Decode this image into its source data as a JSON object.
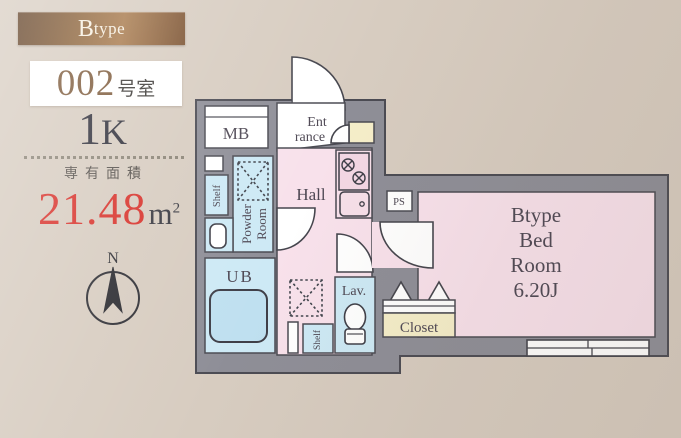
{
  "panel": {
    "type_badge_initial": "B",
    "type_badge_rest": "type",
    "room_no": "002",
    "room_no_suffix": "号室",
    "layout_first": "1",
    "layout_rest": "K",
    "area_caption": "専有面積",
    "area_value": "21.48",
    "area_unit_base": "m",
    "area_unit_exp": "2"
  },
  "compass": {
    "north": "N"
  },
  "floorplan": {
    "labels": {
      "mb": "MB",
      "entrance_l1": "Ent",
      "entrance_l2": "rance",
      "hall": "Hall",
      "ps": "PS",
      "shelf_upper": "Shelf",
      "powder_l1": "Powder",
      "powder_l2": "Room",
      "ub": "UB",
      "shelf_lower": "Shelf",
      "lav": "Lav.",
      "closet": "Closet",
      "bedroom_l1": "Btype",
      "bedroom_l2": "Bed",
      "bedroom_l3": "Room",
      "bedroom_l4": "6.20J"
    },
    "colors": {
      "wall": "#8e8e97",
      "wall_outline": "#4b4b53",
      "pink_room": "#f8e1eb",
      "blue_room": "#cde9f5",
      "cream_room": "#f5eec9",
      "white_room": "#ffffff"
    }
  },
  "theme": {
    "background": "#d7ccc0",
    "banner_brown_dark": "#5e3d22",
    "banner_brown_light": "#a87a4c",
    "accent_red": "#d8322b",
    "number_brown": "#7d5a3a",
    "text_dark": "#30303b"
  }
}
